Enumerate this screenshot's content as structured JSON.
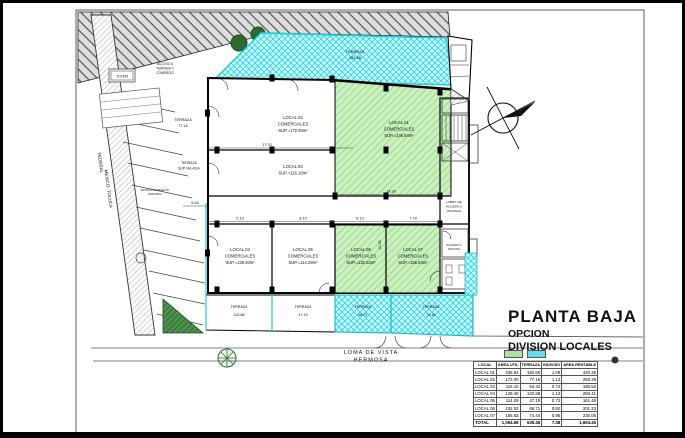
{
  "colors": {
    "local_green_fill": "#c9f0bd",
    "local_green_line": "#65b665",
    "terrace_cyan_fill": "#c6f5f9",
    "terrace_cyan_line": "#17cfe0",
    "road_hatch": "#666666"
  },
  "plan": {
    "streets": {
      "left1": "FEDERAL",
      "left2": "MEXICO- TOLUCA",
      "bottom1": "LOMA  DE  VISTA",
      "bottom2": "HERMOSA"
    },
    "access_top": [
      "ACCESO A",
      "TERRAZA Y",
      "COMERCIO"
    ],
    "totem": "TOTEM",
    "parking1": "ESTACIONAMIENTO",
    "parking2": "PRIVADO",
    "terrace_top": [
      "TERRAZA",
      "182.66"
    ],
    "terrace_left": [
      "TERRAZA",
      "77.16"
    ],
    "terrace_mid": [
      "TERRAZA",
      "SUP.=64.42m²"
    ],
    "lobby": [
      "LOBBY DE",
      "ACCESO A",
      "OFICINAS"
    ],
    "office": [
      "ACCESO A",
      "OFICINA"
    ],
    "locales": [
      [
        "LOCAL.01",
        "COMERCIALES",
        "SUP.=235.84m²"
      ],
      [
        "LOCAL.02",
        "COMERCIALES",
        "SUP.=172.00m²"
      ],
      [
        "LOCAL 03",
        "SUP.=116.10m²"
      ],
      [
        "LOCAL.04",
        "COMERCIALES",
        "SUP.=128.40m²"
      ],
      [
        "LOCAL.05",
        "COMERCIALES",
        "SUP.=114.29m²"
      ],
      [
        "LOCAL.06",
        "COMERCIALES",
        "SUP.=132.52m²"
      ],
      [
        "LOCAL.07",
        "COMERCIALES",
        "SUP.=155.53m²"
      ]
    ],
    "terraces_bottom": [
      [
        "TERRAZA",
        "120.88"
      ],
      [
        "TERRAZA",
        "47.19"
      ],
      [
        "TERRAZA",
        "68.71"
      ],
      [
        "TERRAZA",
        "74.44"
      ]
    ],
    "dims": {
      "w2": "17.20",
      "w4": "9.13",
      "w5": "8.10",
      "w6": "8.10",
      "w7": "7.78",
      "left": "5.84",
      "w1": "14.38",
      "h1": "16.36"
    }
  },
  "title_block": {
    "title": "PLANTA BAJA",
    "line2": "OPCION",
    "line3": "DIVISION LOCALES"
  },
  "table": {
    "headers": [
      "LOCAL",
      "AREA UTIL",
      "TERRAZA",
      "INDIVISO",
      "AREA RENTABLE"
    ],
    "rows": [
      [
        "LOCAL 01",
        "235.84",
        "182.66",
        "1.09",
        "420.36"
      ],
      [
        "LOCAL 02",
        "172.00",
        "77.16",
        "1.13",
        "250.39"
      ],
      [
        "LOCAL 03",
        "116.10",
        "64.42",
        "0.73",
        "180.52"
      ],
      [
        "LOCAL 04",
        "128.40",
        "120.88",
        "1.13",
        "250.41"
      ],
      [
        "LOCAL 05",
        "114.29",
        "47.19",
        "0.73",
        "161.48"
      ],
      [
        "LOCAL 06",
        "132.52",
        "68.71",
        "0.82",
        "201.23"
      ],
      [
        "LOCAL 07",
        "155.53",
        "74.44",
        "0.95",
        "230.06"
      ]
    ],
    "total": [
      "TOTAL",
      "1,054.68",
      "635.46",
      "7.38",
      "1,694.45"
    ]
  }
}
